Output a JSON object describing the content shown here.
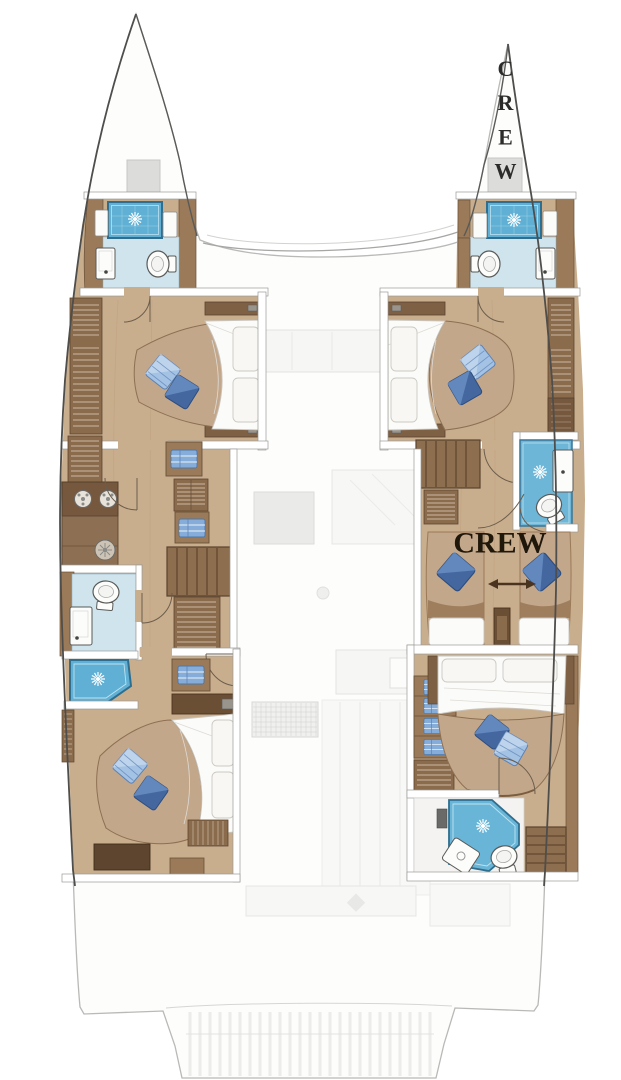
{
  "labels": {
    "crew_bow": "CREW",
    "crew_cabin": "CREW"
  },
  "colors": {
    "background": "#ffffff",
    "hull_outline": "#4e4e4c",
    "ghost_line": "#c4c4c2",
    "wood_floor": "#c9ae8d",
    "wood_mid": "#9a7a58",
    "wood_dark": "#7e6045",
    "wood_bench": "#5e452f",
    "bathroom_floor": "#cfe4ed",
    "shower_tile": "#5fb0d4",
    "mattress": "#fbfbf9",
    "bed_platform": "#c3a78a",
    "pillow_dark": "#44679f",
    "pillow_light": "#a3c2e4",
    "crew_text": "#20170b",
    "arrow": "#4a3420"
  },
  "icons": {
    "shower": "starburst-rose",
    "toilet": "oval-bowl-with-tank",
    "sink": "white-console",
    "deck_hatch": "spoked-circle",
    "wardrobe": "striped-panel",
    "stairs": "slatted-block"
  }
}
